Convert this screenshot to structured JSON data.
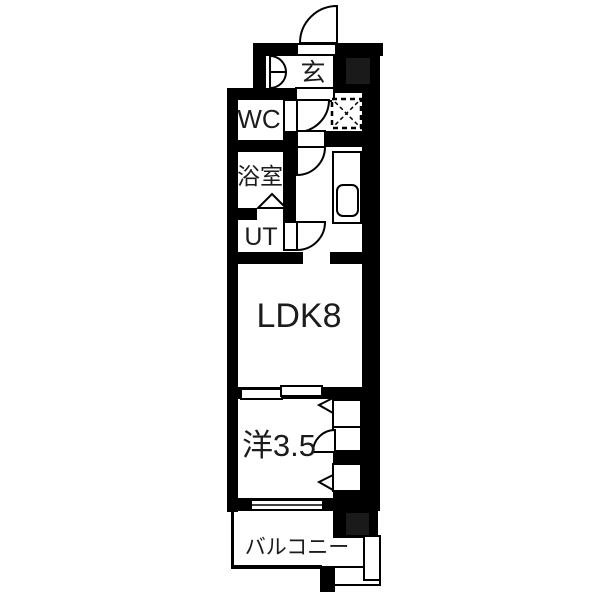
{
  "diagram": {
    "type": "apartment-floorplan",
    "rooms": {
      "entrance": {
        "label": "玄"
      },
      "wc": {
        "label": "WC"
      },
      "bathroom": {
        "label": "浴室"
      },
      "utility": {
        "label": "UT"
      },
      "living": {
        "label": "LDK8"
      },
      "western": {
        "label": "洋3.5"
      },
      "balcony": {
        "label": "バルコニー"
      }
    },
    "colors": {
      "wall": "#000000",
      "floor": "#ffffff",
      "shaft_fill": "#1a1a1a"
    },
    "symbols": {
      "entrance_door": "quarter-arc-swing",
      "wc_door": "quarter-arc-swing",
      "ldk_door": "quarter-arc-swing",
      "utility_door": "quarter-arc-swing",
      "bathroom_door": "triangle-fold",
      "shoe_cabinet": "double-curved-flaps",
      "washing_machine": "dashed-square-x",
      "kitchen_sink": "rounded-rect",
      "sliding_partition": "offset-double-panels",
      "window": "double-line",
      "closet_doors": "triangle-markers",
      "balcony_railing": "thin-outline"
    }
  }
}
